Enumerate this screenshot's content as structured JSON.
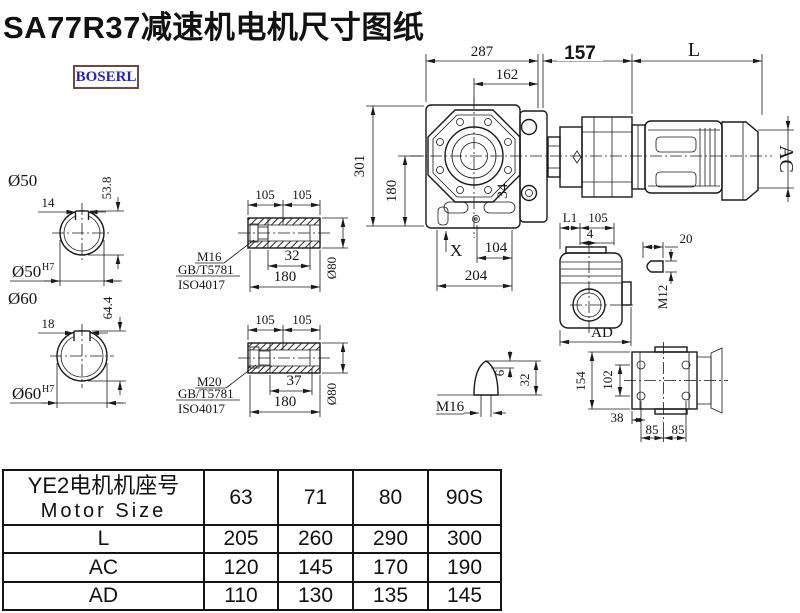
{
  "title": "SA77R37减速机电机尺寸图纸",
  "logo": "BOSERL",
  "mv": {
    "d287": "287",
    "d162": "162",
    "d157": "157",
    "dL": "L",
    "d301": "301",
    "d180": "180",
    "d34": "34",
    "dX": "X",
    "d104": "104",
    "d204": "204",
    "dAC": "AC"
  },
  "s50": {
    "title": "Ø50",
    "w": "14",
    "h": "53.8",
    "bore": "Ø50",
    "sup": "H7"
  },
  "s60": {
    "title": "Ø60",
    "w": "18",
    "h": "64.4",
    "bore": "Ø60",
    "sup": "H7"
  },
  "hu": {
    "p105a": "105",
    "p105b": "105",
    "bolt": "M16",
    "std1": "GB/T5781",
    "std2": "ISO4017",
    "depth": "32",
    "len": "180",
    "dia": "Ø80"
  },
  "hl": {
    "p105a": "105",
    "p105b": "105",
    "bolt": "M20",
    "std1": "GB/T5781",
    "std2": "ISO4017",
    "depth": "37",
    "len": "180",
    "dia": "Ø80"
  },
  "sv": {
    "L1": "L1",
    "p105": "105",
    "p4": "4",
    "AD": "AD"
  },
  "kd": {
    "p20": "20",
    "thread": "M12"
  },
  "rv": {
    "p154": "154",
    "p102": "102",
    "p38": "38",
    "p85a": "85",
    "p85b": "85"
  },
  "pd": {
    "thread": "M16",
    "p6": "6",
    "p32": "32"
  },
  "table": {
    "header_cn": "YE2电机机座号",
    "header_en": "Motor Size",
    "sizes": [
      "63",
      "71",
      "80",
      "90S"
    ],
    "rows": [
      {
        "label": "L",
        "values": [
          "205",
          "260",
          "290",
          "300"
        ]
      },
      {
        "label": "AC",
        "values": [
          "120",
          "145",
          "170",
          "190"
        ]
      },
      {
        "label": "AD",
        "values": [
          "110",
          "130",
          "135",
          "145"
        ]
      }
    ]
  }
}
